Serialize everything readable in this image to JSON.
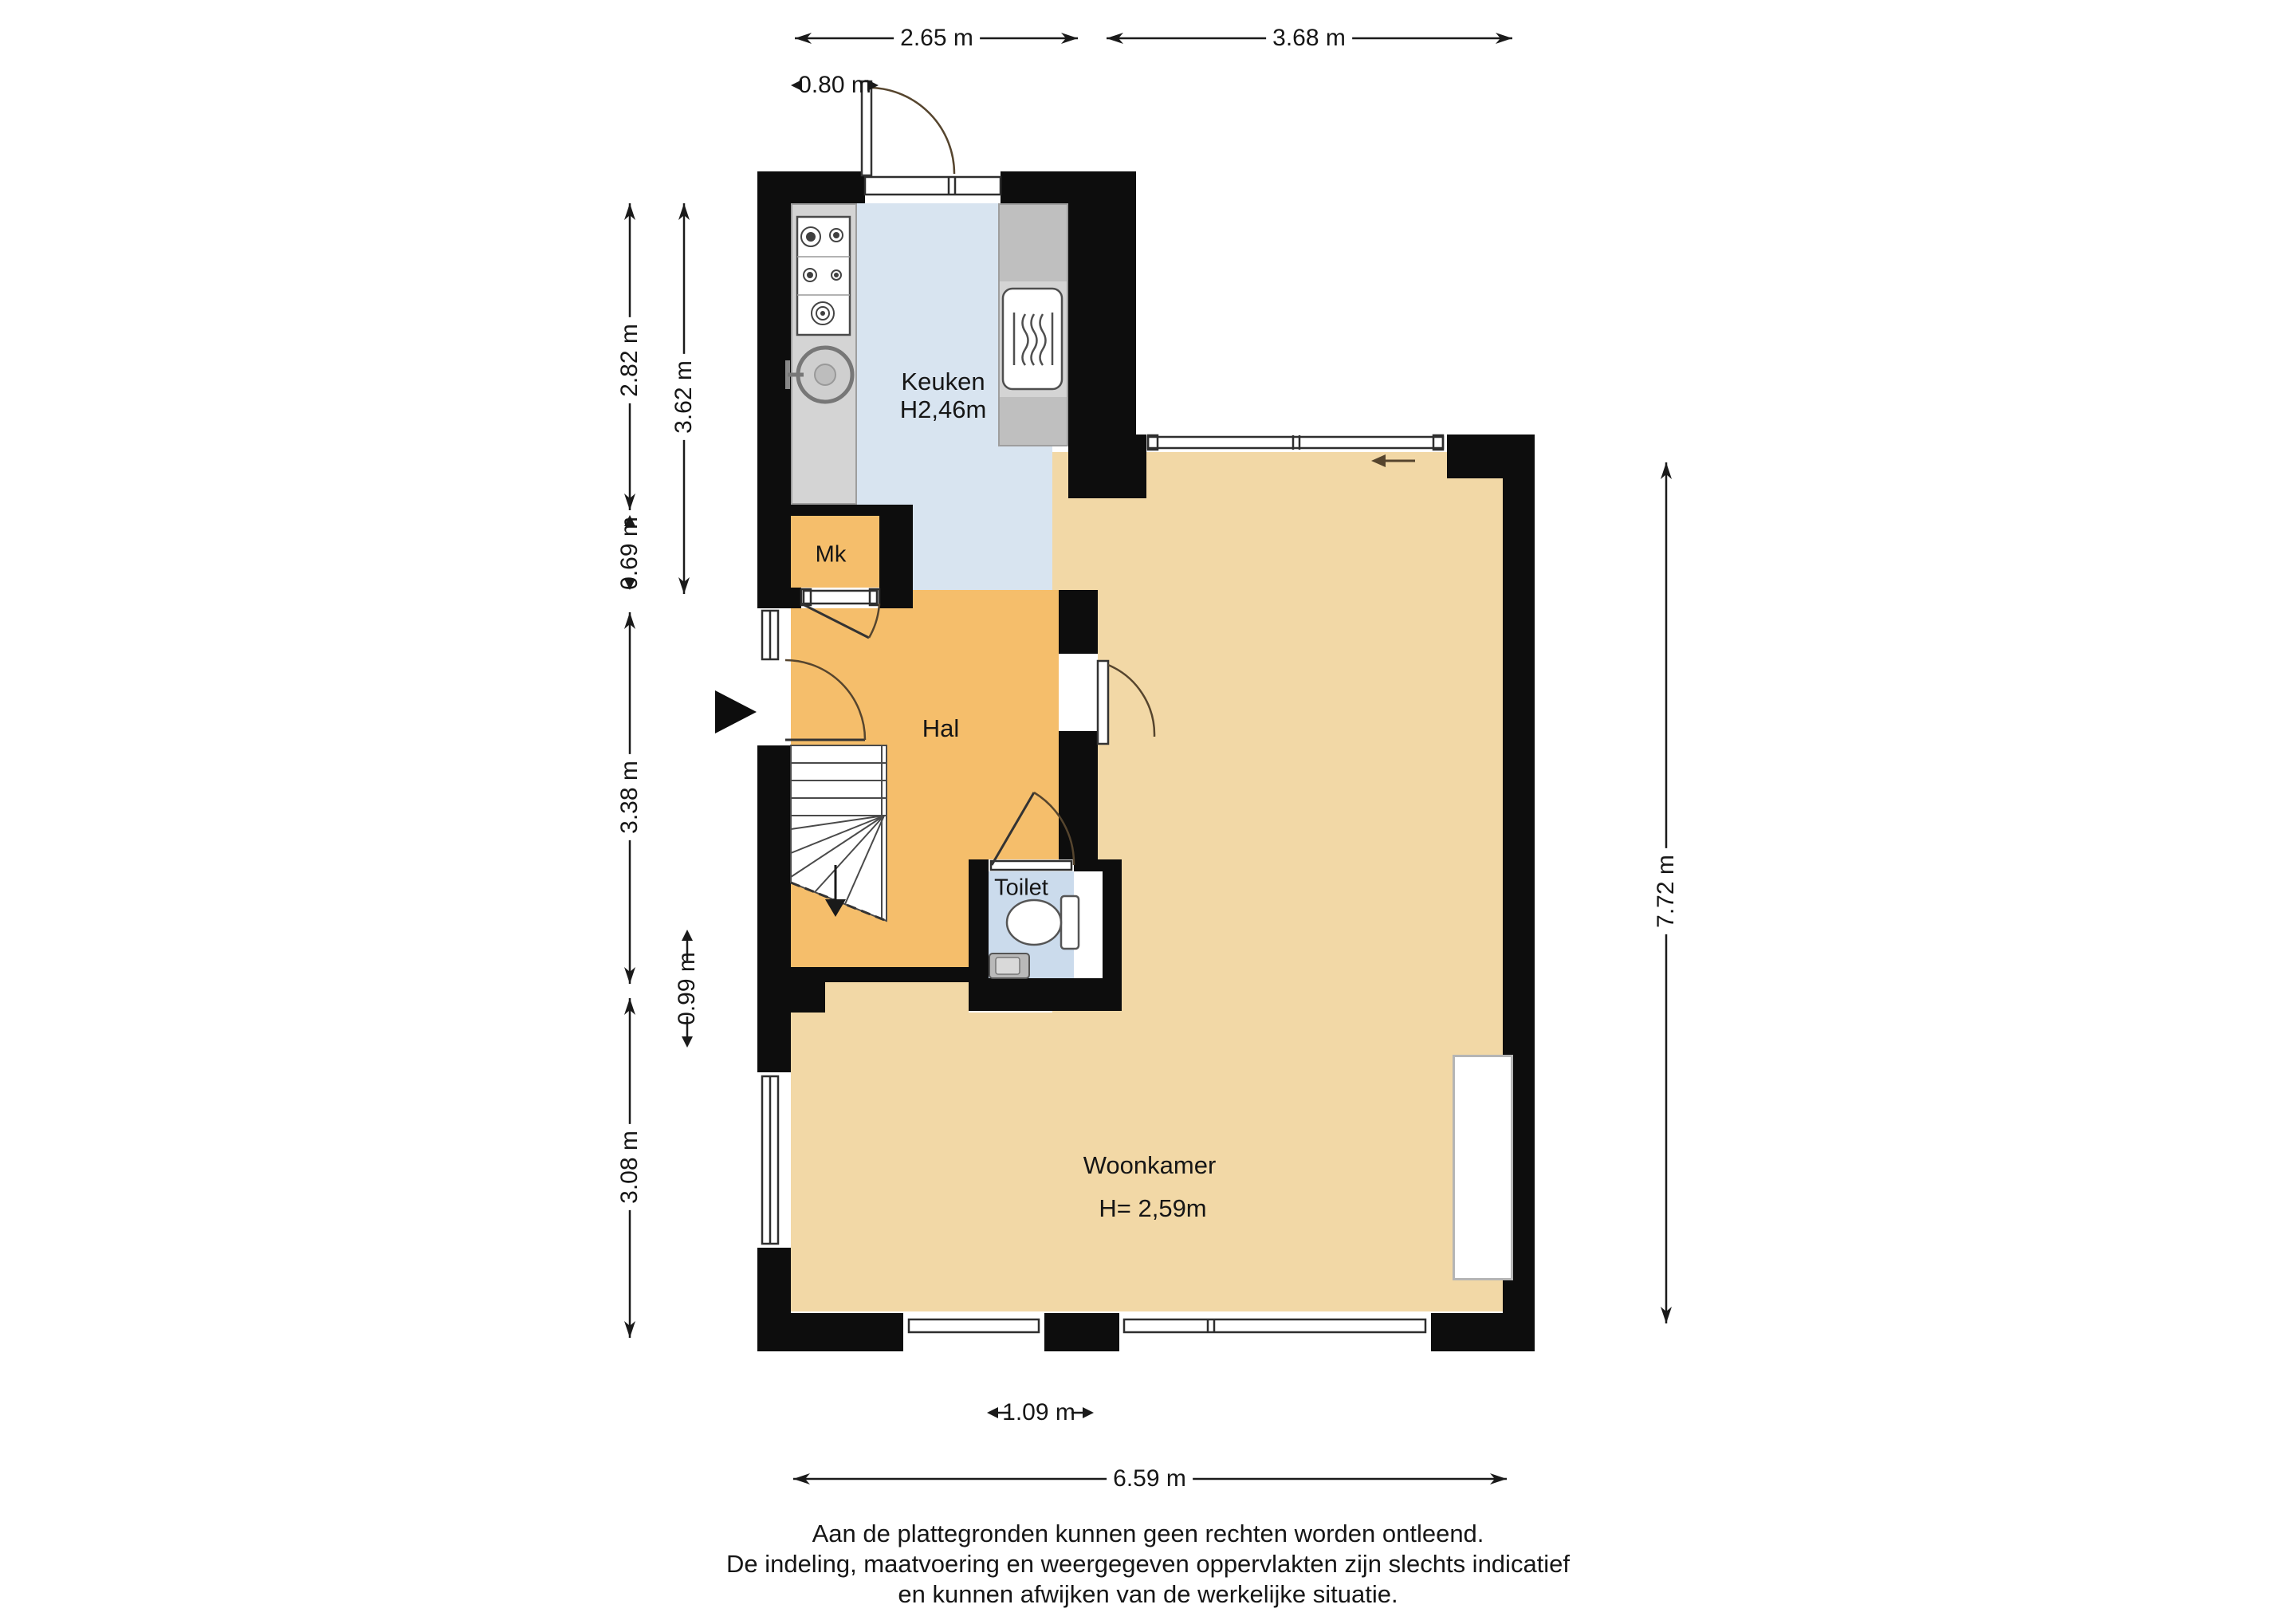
{
  "rooms": {
    "keuken": {
      "name": "Keuken",
      "height": "H2,46m"
    },
    "mk": {
      "name": "Mk"
    },
    "hal": {
      "name": "Hal"
    },
    "toilet": {
      "name": "Toilet"
    },
    "woonkamer": {
      "name": "Woonkamer",
      "height": "H= 2,59m"
    }
  },
  "dimensions": {
    "top_kitchen_width": "2.65 m",
    "top_livingroom_width": "3.68 m",
    "back_door_width": "0.80 m",
    "left_kitchen_height": "2.82 m",
    "left_kitchen_inner_height": "3.62 m",
    "left_mk_height": "0.69 m",
    "left_hal_height": "3.38 m",
    "left_stairs_height": "0.99 m",
    "left_livingroom_height": "3.08 m",
    "right_total_height": "7.72 m",
    "bottom_window_width": "1.09 m",
    "bottom_total_width": "6.59 m"
  },
  "disclaimer": {
    "lines": [
      "Aan de plattegronden kunnen geen rechten worden ontleend.",
      "De indeling, maatvoering en weergegeven oppervlakten zijn slechts indicatief",
      "en kunnen afwijken van de werkelijke situatie."
    ]
  },
  "colors": {
    "wall": "#0D0D0D",
    "hal": "#F5BE6B",
    "woonkamer": "#F2D8A6",
    "keuken": "#D8E4F0",
    "toilet": "#CBDBEC",
    "counter": "#D4D4D4",
    "counterDark": "#BFBFBF",
    "ink": "#161616"
  }
}
